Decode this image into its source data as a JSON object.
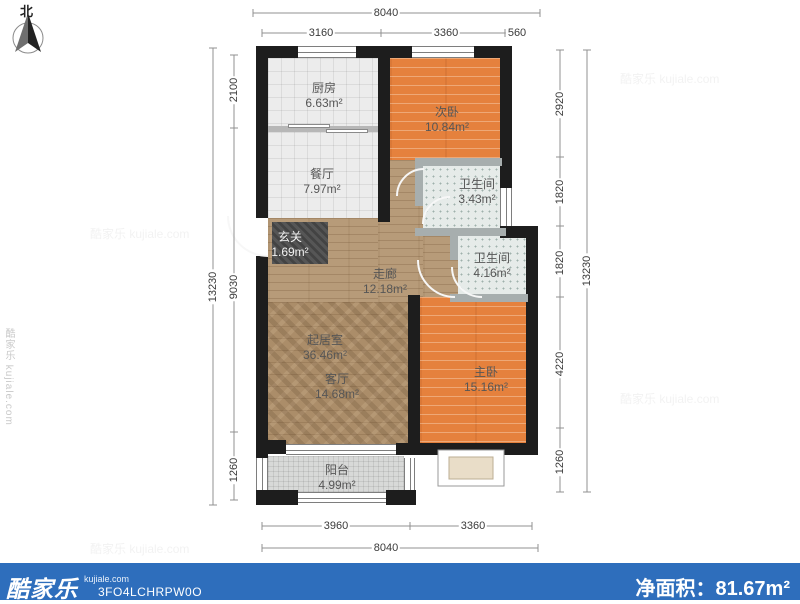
{
  "compass": {
    "north_label": "北"
  },
  "watermark": {
    "text": "酷家乐 kujiale.com"
  },
  "rooms": [
    {
      "id": "kitchen",
      "name": "厨房",
      "area": "6.63m²"
    },
    {
      "id": "dining",
      "name": "餐厅",
      "area": "7.97m²"
    },
    {
      "id": "second-bedroom",
      "name": "次卧",
      "area": "10.84m²"
    },
    {
      "id": "bathroom-1",
      "name": "卫生间",
      "area": "3.43m²"
    },
    {
      "id": "bathroom-2",
      "name": "卫生间",
      "area": "4.16m²"
    },
    {
      "id": "entry",
      "name": "玄关",
      "area": "1.69m²"
    },
    {
      "id": "corridor",
      "name": "走廊",
      "area": "12.18m²"
    },
    {
      "id": "living",
      "name": "起居室",
      "area": "36.46m²"
    },
    {
      "id": "parlor",
      "name": "客厅",
      "area": "14.68m²"
    },
    {
      "id": "master-bedroom",
      "name": "主卧",
      "area": "15.16m²"
    },
    {
      "id": "balcony",
      "name": "阳台",
      "area": "4.99m²"
    }
  ],
  "dimensions": {
    "top": {
      "total": "8040",
      "segments": [
        "3160",
        "3360",
        "560"
      ]
    },
    "bottom": {
      "total": "8040",
      "segments": [
        "3960",
        "3360"
      ]
    },
    "left": {
      "total": "13230",
      "segments": [
        "2100",
        "9030",
        "1260"
      ]
    },
    "right": {
      "total": "13230",
      "segments": [
        "2920",
        "1820",
        "1820",
        "4220",
        "1260"
      ]
    }
  },
  "footer": {
    "brand": "酷家乐",
    "brand_domain": "kujiale.com",
    "plan_code": "3FO4LCHRPW0O",
    "net_area_label": "净面积：",
    "net_area_value": "81.67m²"
  },
  "colors": {
    "footer_blue": "#2e6ebc",
    "wall_black": "#1d1d1d",
    "bedroom_wood": "#e5813d",
    "corridor_wood": "#b79b79",
    "tile_gray": "#ececec",
    "bath_tile": "#e6ebe9"
  }
}
